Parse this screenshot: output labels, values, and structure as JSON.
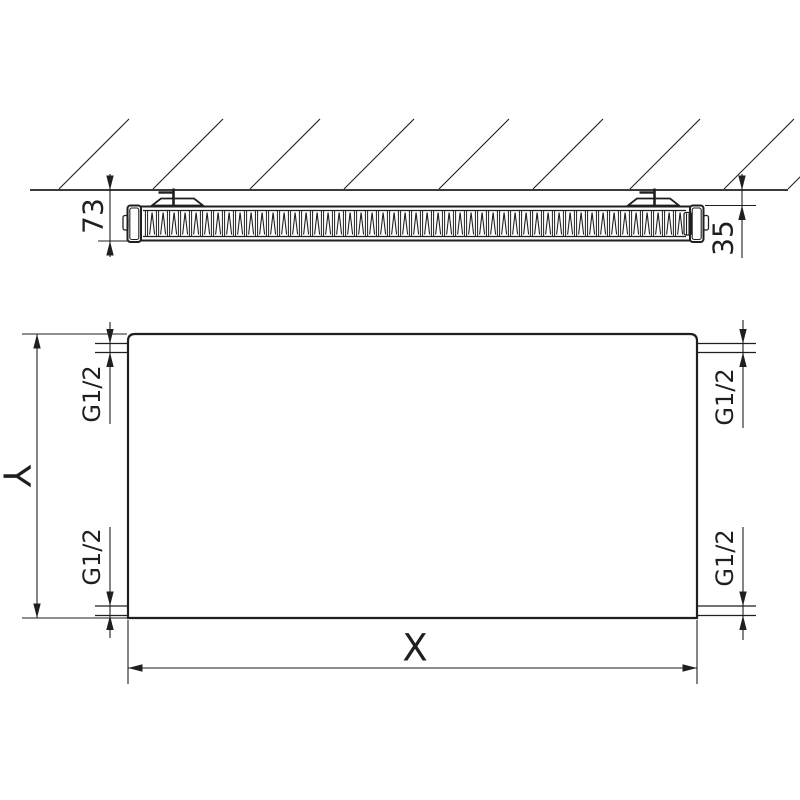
{
  "drawing": {
    "background_color": "#ffffff",
    "line_color": "#1f1f1f",
    "top_view": {
      "depth_label": "73",
      "wall_distance_label": "35"
    },
    "front_view": {
      "width_label": "X",
      "height_label": "Y",
      "connections": {
        "top_left_label": "G1/2",
        "bottom_left_label": "G1/2",
        "top_right_label": "G1/2",
        "bottom_right_label": "G1/2"
      }
    }
  }
}
